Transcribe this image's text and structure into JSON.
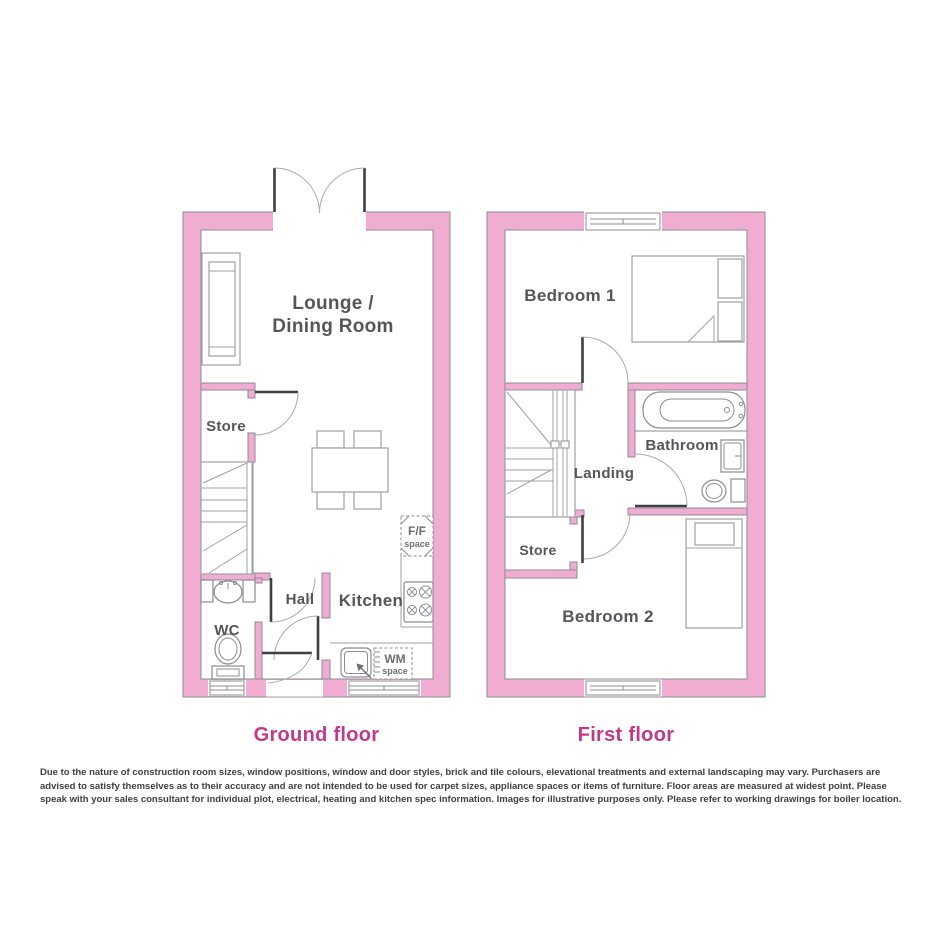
{
  "ground_floor": {
    "caption": "Ground floor",
    "rooms": {
      "lounge_line1": "Lounge /",
      "lounge_line2": "Dining Room",
      "store": "Store",
      "hall": "Hall",
      "kitchen": "Kitchen",
      "wc": "WC"
    },
    "appliances": {
      "ff_line1": "F/F",
      "ff_line2": "space",
      "wm_line1": "WM",
      "wm_line2": "space"
    }
  },
  "first_floor": {
    "caption": "First floor",
    "rooms": {
      "bedroom1": "Bedroom 1",
      "bathroom": "Bathroom",
      "landing": "Landing",
      "store": "Store",
      "bedroom2": "Bedroom 2"
    }
  },
  "disclaimer": "Due to the nature of construction room sizes, window positions, window and door styles, brick and tile colours, elevational treatments and external landscaping may vary. Purchasers are advised to satisfy themselves as to their accuracy and are not intended to be used for carpet sizes, appliance spaces or items of furniture. Floor areas are measured at widest point. Please speak with your sales consultant for individual plot, electrical, heating and kitchen spec information. Images for illustrative purposes only. Please refer to working drawings for boiler location.",
  "colors": {
    "wall_pink": "#F1ACD2",
    "outline_gray": "#8C8E91",
    "label_gray": "#55565A",
    "caption_magenta": "#C2398A",
    "door_dark": "#3E3F41"
  }
}
